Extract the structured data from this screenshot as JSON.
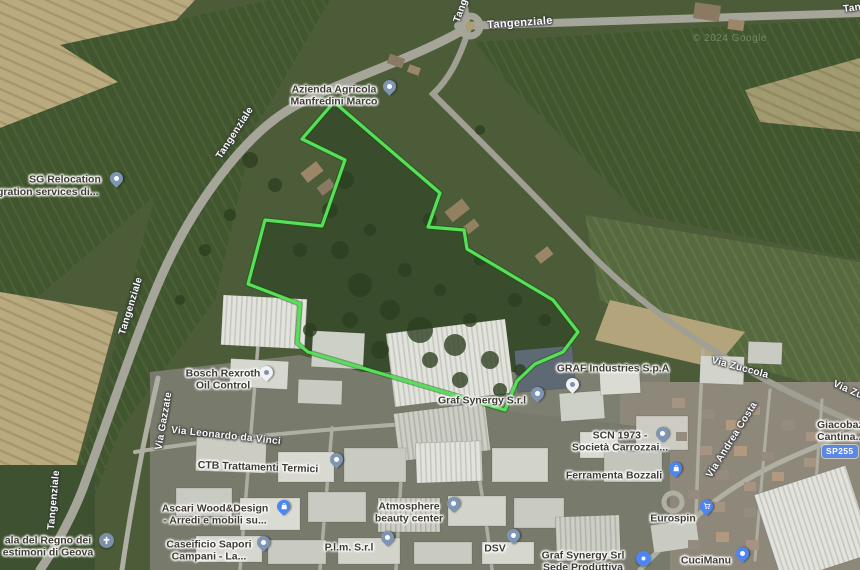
{
  "map_type": "satellite",
  "watermark": "© 2024 Google",
  "roads": {
    "tangenziale": "Tangenziale",
    "via_zuccola": "Via Zuccola",
    "via_andrea_costa": "Via Andrea Costa",
    "via_gazzate": "Via Gazzate",
    "via_leonardo_da_vinci": "Via Leonardo da Vinci",
    "route_badge": "SP255"
  },
  "places": {
    "azienda_agricola": {
      "line1": "Azienda Agricola",
      "line2": "Manfredini Marco"
    },
    "sg_relocation": {
      "line1": "SG Relocation",
      "line2": "gration services di..."
    },
    "bosch": {
      "line1": "Bosch Rexroth",
      "line2": "Oil Control"
    },
    "graf_industries": {
      "line1": "GRAF Industries S.p.A"
    },
    "graf_synergy": {
      "line1": "Graf Synergy S.r.l"
    },
    "scn": {
      "line1": "SCN 1973 -",
      "line2": "Società Carrozzai..."
    },
    "ferramenta": {
      "line1": "Ferramenta Bozzali"
    },
    "atmosphere": {
      "line1": "Atmosphere",
      "line2": "beauty center"
    },
    "ctb": {
      "line1": "CTB Trattamenti Termici"
    },
    "ascari": {
      "line1": "Ascari Wood&Design",
      "line2": "- Arredi e mobili su..."
    },
    "caseificio": {
      "line1": "Caseificio Sapori",
      "line2": "Campani - La..."
    },
    "sala_regno": {
      "line1": "ala del Regno dei",
      "line2": "estimoni di Geova"
    },
    "plm": {
      "line1": "P.l.m. S.r.l"
    },
    "dsv": {
      "line1": "DSV"
    },
    "graf_synergy_sede": {
      "line1": "Graf Synergy Srl",
      "line2": "Sede Produttiva"
    },
    "eurospin": {
      "line1": "Eurospin"
    },
    "cucimanu": {
      "line1": "CuciManu"
    },
    "giacobazzi": {
      "line1": "Giacobazzi",
      "line2": "Cantina..."
    }
  },
  "icons": {
    "map_pin": "teardrop-pin",
    "poi_circle": "circle-poi",
    "shopping_bag": "bag-glyph",
    "shopping_cart": "cart-glyph",
    "church_cross": "cross-glyph"
  },
  "colors": {
    "property_outline": "#57df57",
    "poi_blue": "#4d86f2",
    "pin_slate": "#7e95b3",
    "pin_white": "#f0f2f5",
    "route_badge_bg": "#5c87e5"
  }
}
